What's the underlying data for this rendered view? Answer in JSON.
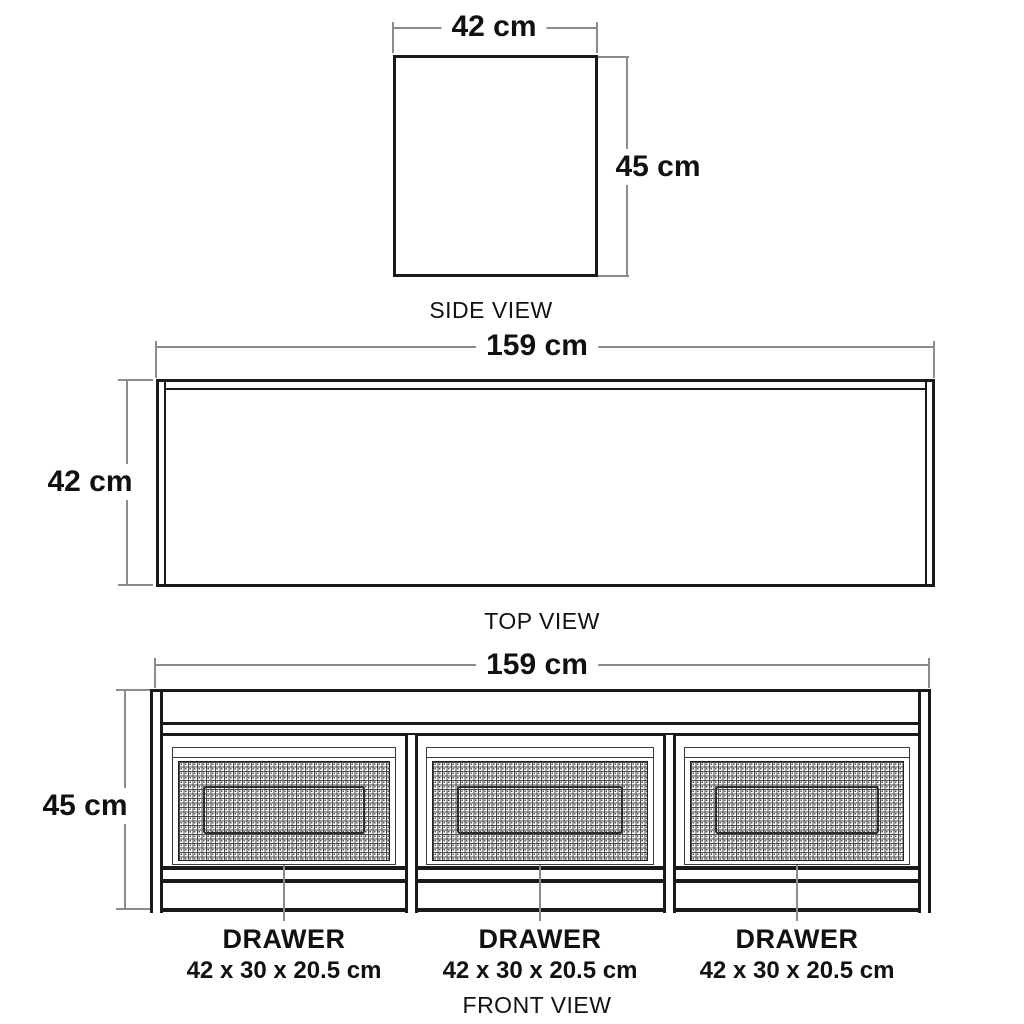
{
  "side": {
    "caption": "SIDE VIEW",
    "width_label": "42 cm",
    "height_label": "45 cm"
  },
  "top": {
    "caption": "TOP VIEW",
    "width_label": "159 cm",
    "depth_label": "42 cm"
  },
  "front": {
    "caption": "FRONT VIEW",
    "width_label": "159 cm",
    "height_label": "45 cm",
    "drawers": [
      {
        "label": "DRAWER",
        "size": "42 x 30 x 20.5 cm"
      },
      {
        "label": "DRAWER",
        "size": "42 x 30 x 20.5 cm"
      },
      {
        "label": "DRAWER",
        "size": "42 x 30 x 20.5 cm"
      }
    ]
  },
  "colors": {
    "drawing_line": "#1a1a1a",
    "dimension_line": "#8c8c8c",
    "background": "#ffffff",
    "text": "#111111"
  }
}
